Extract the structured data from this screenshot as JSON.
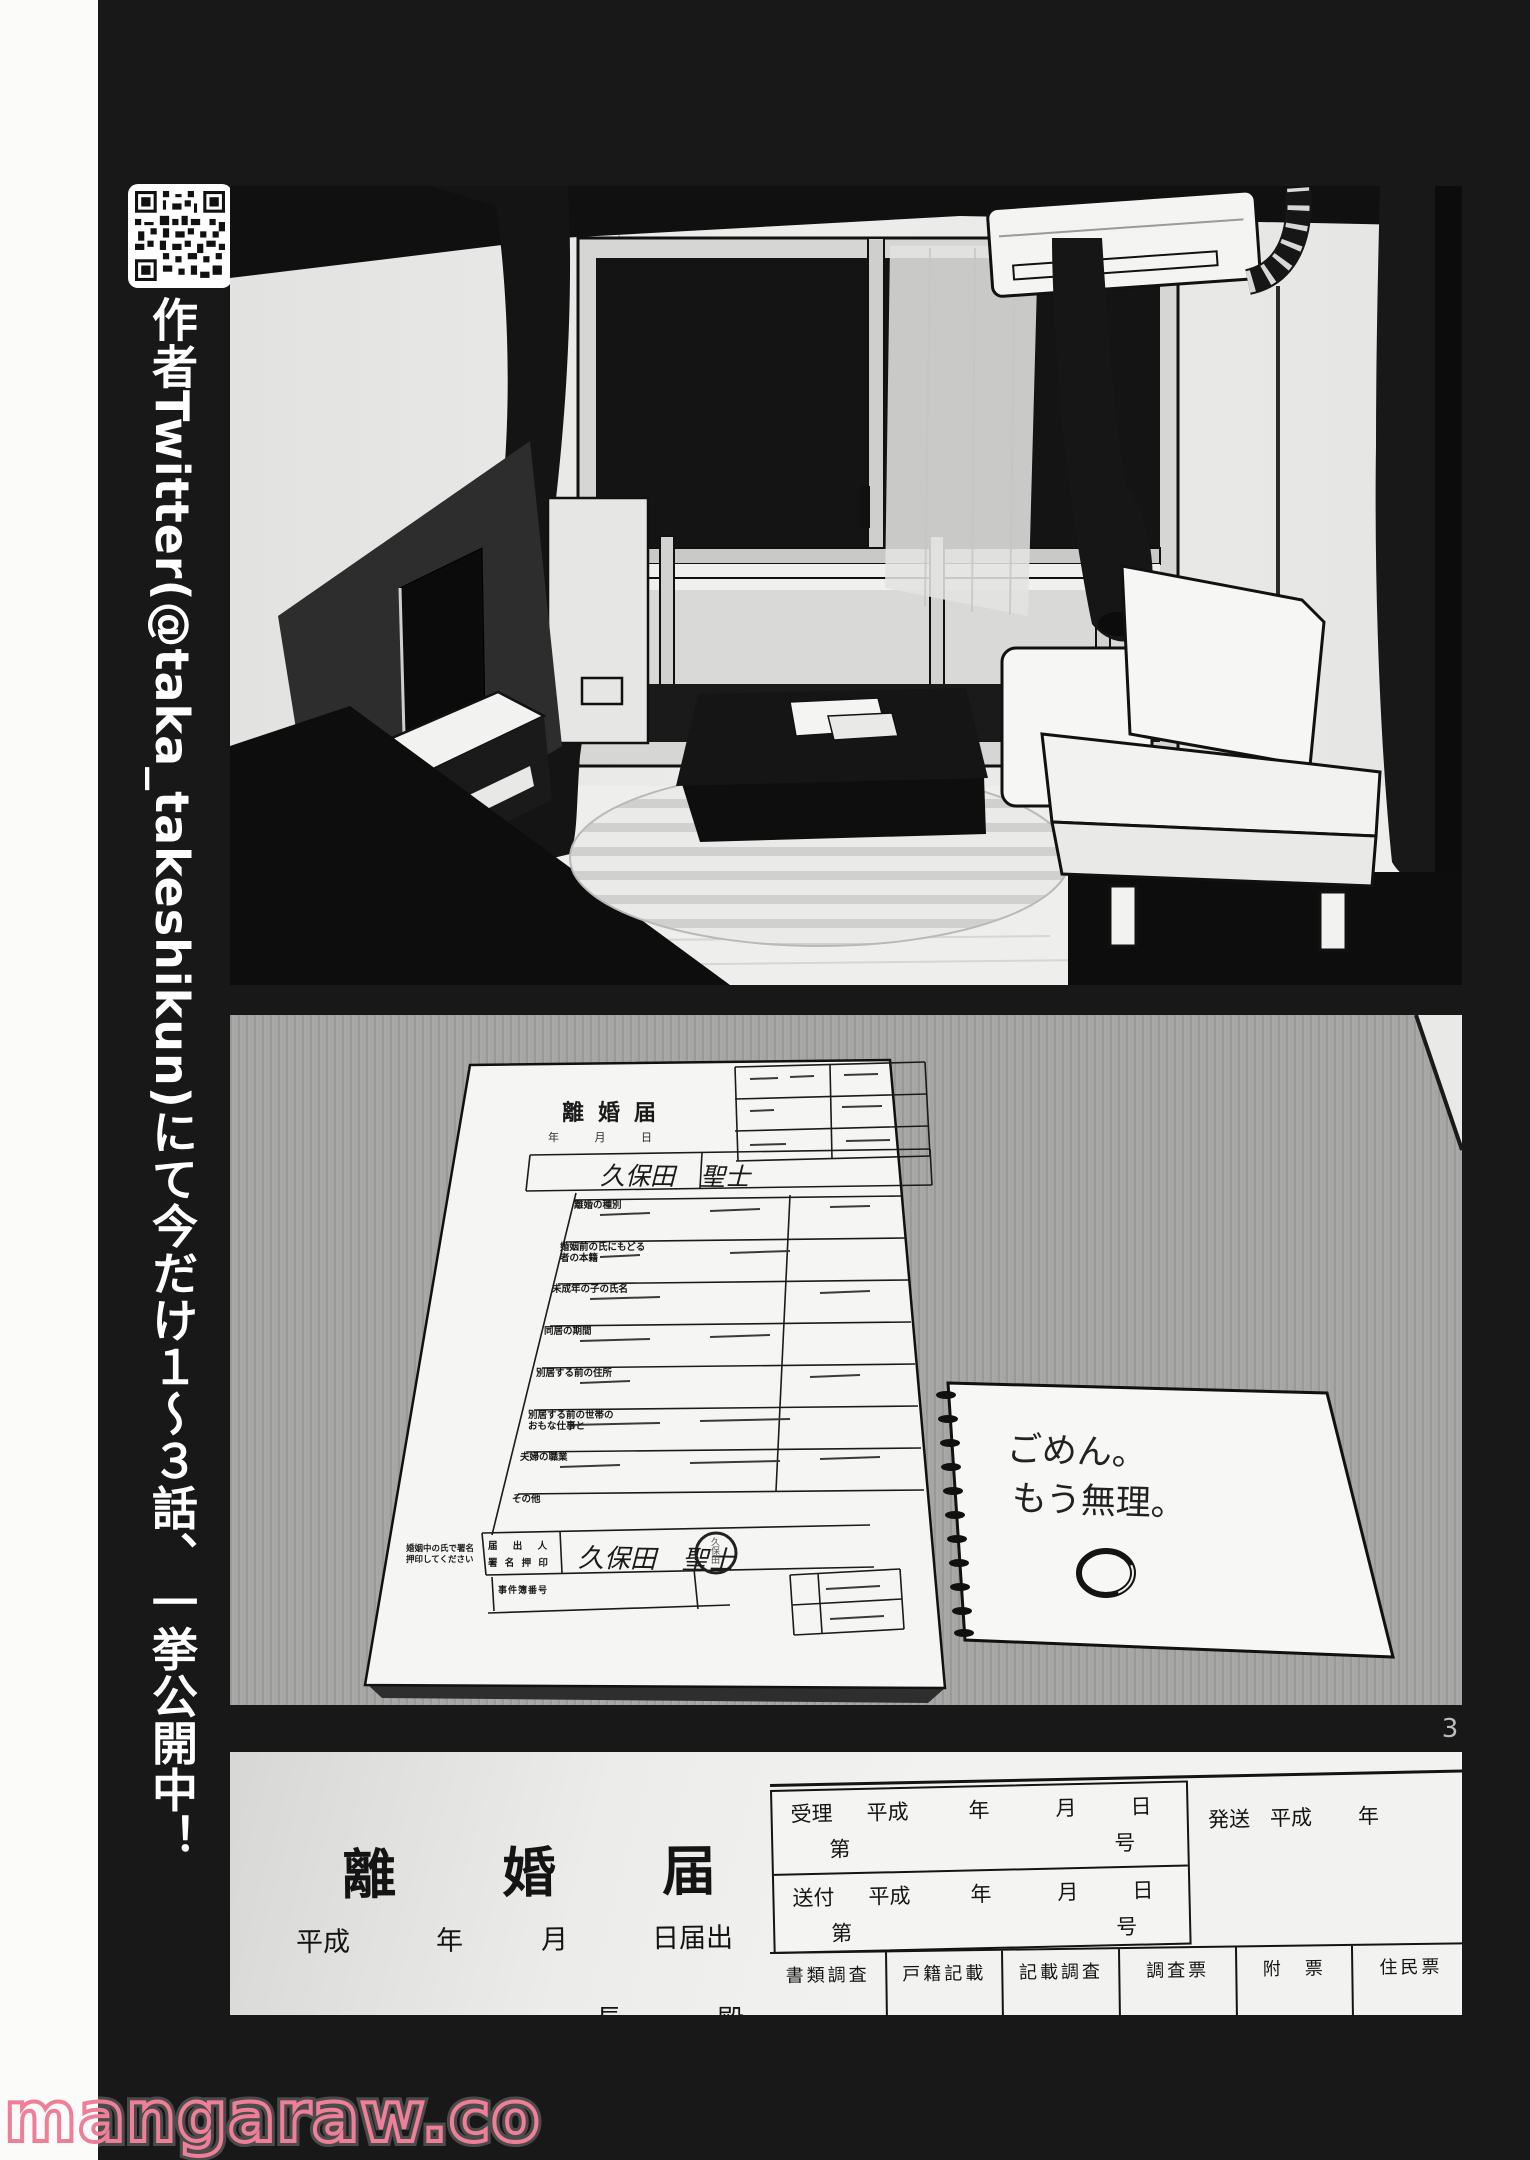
{
  "page_number": "3",
  "sidebar": {
    "tagline": "作者Twitter(@taka_takeshikun)にて今だけ１〜３話、一挙公開中！"
  },
  "watermark": {
    "text": "mangaraw.co",
    "color": "#ef7f97"
  },
  "divorce_paper": {
    "title": "離婚届",
    "header_date": "年 月 日",
    "name": "久保田　聖士",
    "rows": [
      "離婚の種別",
      "婚姻前の氏にもどる者の本籍",
      "未成年の子の氏名",
      "同居の期間",
      "別居する前の住所",
      "別居する前の世帯のおもな仕事と",
      "夫婦の職業",
      "その他"
    ],
    "sign_label_1": "婚姻中の氏で署名",
    "sign_label_2": "押印してください",
    "sign_field_1": "届 出 人",
    "sign_field_2": "署 名 押 印",
    "signature": "久保田　聖士",
    "stamp_text": "久保田",
    "case_no_label": "事件簿番号"
  },
  "note": {
    "line1": "ごめん。",
    "line2": "もう無理。"
  },
  "form_closeup": {
    "title": "離婚届",
    "date_row": [
      "平成",
      "年",
      "月",
      "日届出"
    ],
    "recipient": "長　殿",
    "accept_row": [
      "受理",
      "平成",
      "年",
      "月",
      "日"
    ],
    "accept_no": [
      "第",
      "号"
    ],
    "send_row": [
      "送付",
      "平成",
      "年",
      "月",
      "日"
    ],
    "send_no": [
      "第",
      "号"
    ],
    "dispatch_row": [
      "発送",
      "平成",
      "年"
    ],
    "footer_cells": [
      "書類調査",
      "戸籍記載",
      "記載調査",
      "調査票",
      "附　票",
      "住民票"
    ]
  }
}
